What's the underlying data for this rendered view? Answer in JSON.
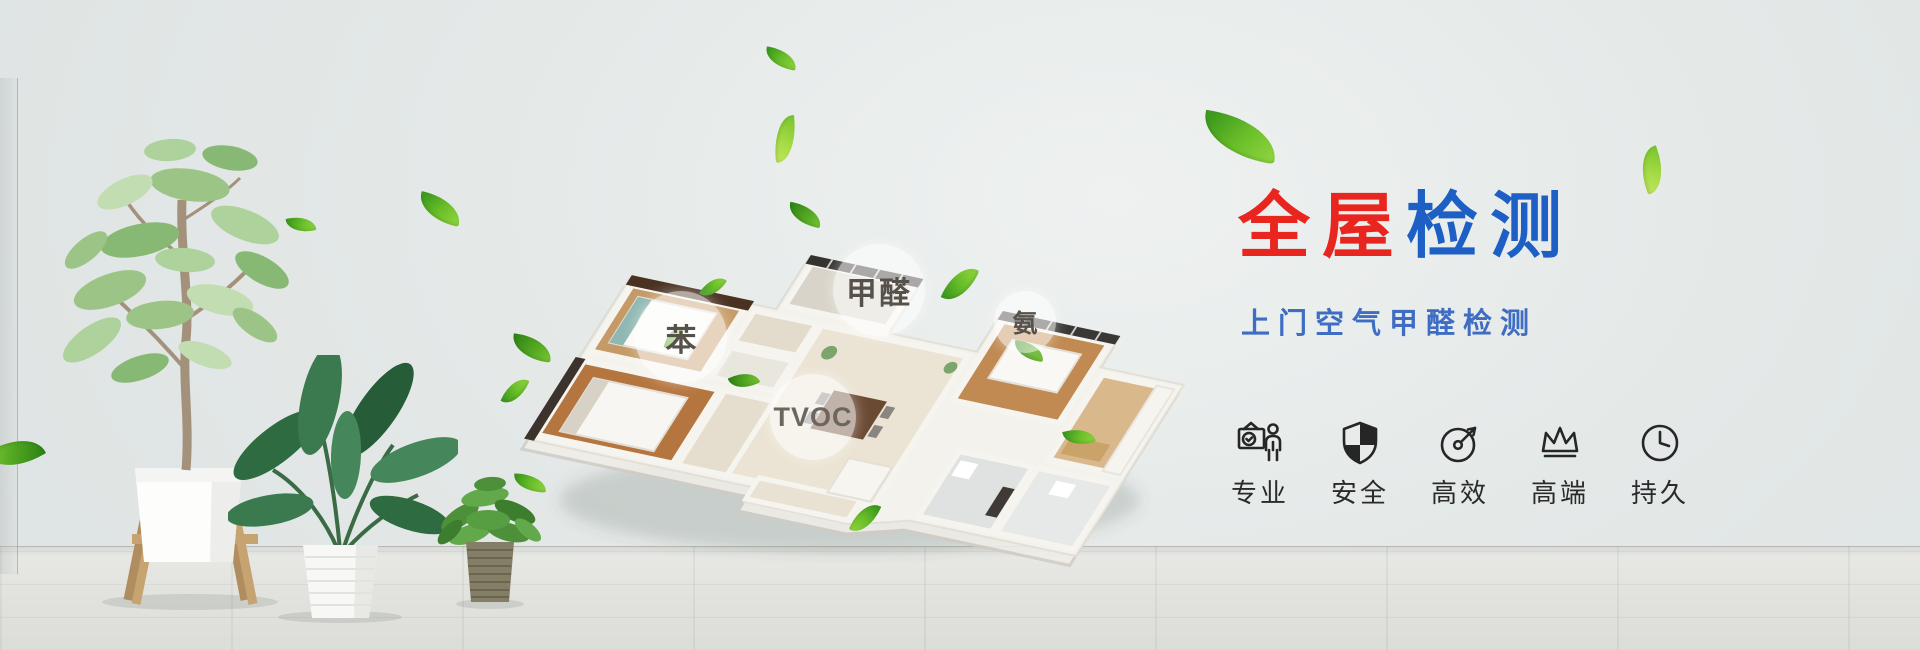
{
  "hero": {
    "title": {
      "red_text": "全屋",
      "blue_text": "检测",
      "red_color": "#e8251e",
      "blue_color": "#1d5fc4"
    },
    "subtitle": {
      "text": "上门空气甲醛检测",
      "color": "#3f6dc3"
    },
    "features": [
      {
        "icon": "certificate-person-icon",
        "label": "专业"
      },
      {
        "icon": "shield-icon",
        "label": "安全"
      },
      {
        "icon": "gauge-arrow-icon",
        "label": "高效"
      },
      {
        "icon": "crown-icon",
        "label": "高端"
      },
      {
        "icon": "clock-icon",
        "label": "持久"
      }
    ],
    "pollutant_bubbles": [
      {
        "id": "benzene",
        "label": "苯"
      },
      {
        "id": "formaldehyde",
        "label": "甲醛"
      },
      {
        "id": "ammonia",
        "label": "氨"
      },
      {
        "id": "tvoc",
        "label": "TVOC"
      }
    ],
    "colors": {
      "leaf_green": "#5fb62e",
      "icon_ink": "#2a2a2a",
      "wall": "#e4e9e8",
      "floor": "#e2e3df"
    }
  }
}
